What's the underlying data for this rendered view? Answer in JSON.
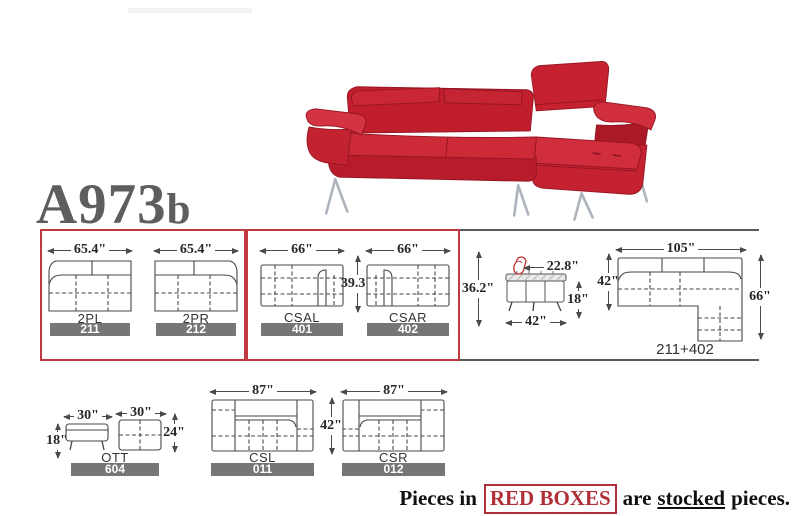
{
  "title": {
    "model": "A973",
    "variant": "b"
  },
  "stocked_row": {
    "box1": {
      "pieces": [
        {
          "name": "2PL",
          "code": "211",
          "width": "65.4\""
        },
        {
          "name": "2PR",
          "code": "212",
          "width": "65.4\""
        }
      ]
    },
    "box2": {
      "pieces": [
        {
          "name": "CSAL",
          "code": "401",
          "width": "66\""
        },
        {
          "name": "CSAR",
          "code": "402",
          "width": "66\""
        }
      ],
      "depth": "39.3\""
    }
  },
  "spec_section": {
    "back_height": "36.2\"",
    "front_view": {
      "headrest_depth": "22.8\"",
      "seat_height": "18\"",
      "width": "42\""
    },
    "sectional": {
      "width": "105\"",
      "sofa_depth": "42\"",
      "chaise_depth": "66\"",
      "combo": "211+402"
    }
  },
  "bottom_row": {
    "ottoman": {
      "name": "OTT",
      "code": "604",
      "front_width": "30\"",
      "front_height": "18\"",
      "top_width": "30\"",
      "top_depth": "24\""
    },
    "csl": {
      "name": "CSL",
      "code": "011",
      "width": "87\""
    },
    "csr": {
      "name": "CSR",
      "code": "012",
      "width": "87\""
    },
    "depth": "42\""
  },
  "footer": {
    "prefix": "Pieces in",
    "highlight": "RED BOXES",
    "middle": "are",
    "underline": "stocked",
    "suffix": "pieces."
  },
  "colors": {
    "stock_box_red": "#bf3a3f",
    "code_bar_gray": "#767676",
    "sofa_red": "#c62532",
    "line_gray": "#4a4a4a",
    "title_gray": "#5e5e5e"
  }
}
